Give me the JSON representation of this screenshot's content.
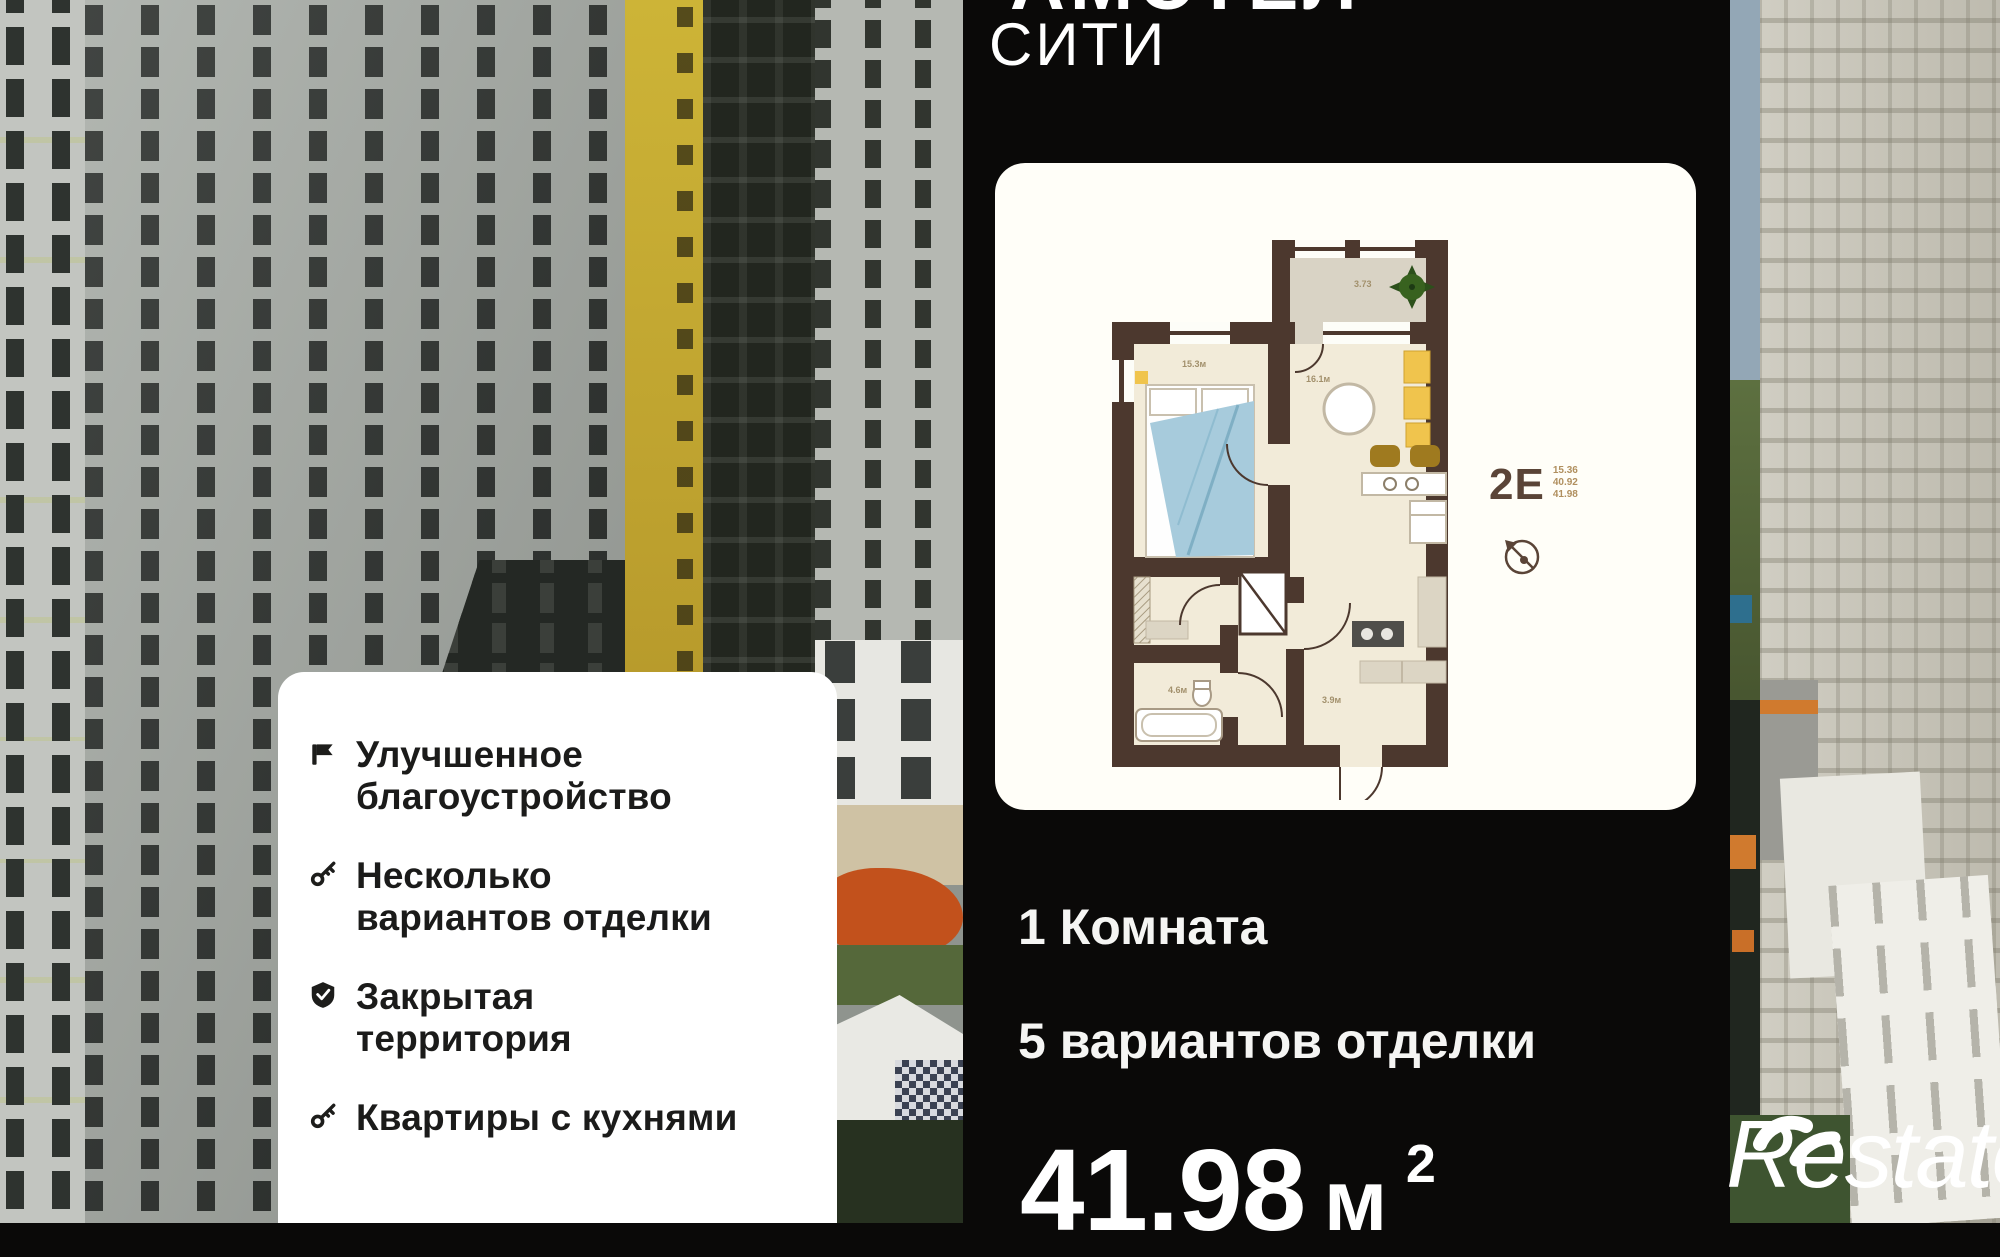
{
  "header": {
    "line1": "АМСТЕЛ",
    "line2": "СИТИ"
  },
  "features": {
    "items": [
      {
        "icon": "flag-icon",
        "lines": [
          "Улучшенное",
          "благоустройство"
        ]
      },
      {
        "icon": "key-icon",
        "lines": [
          "Несколько",
          "вариантов отделки"
        ]
      },
      {
        "icon": "shield-check-icon",
        "lines": [
          "Закрытая",
          "территория"
        ]
      },
      {
        "icon": "key-icon",
        "lines": [
          "Квартиры с кухнями"
        ]
      }
    ]
  },
  "plan": {
    "type_label": "2Е",
    "areas": [
      "15.36",
      "40.92",
      "41.98"
    ],
    "labels": {
      "balcony": "3.73",
      "bedroom": "15.3м",
      "living": "16.1м",
      "bath": "4.6м",
      "hall": "3.9м"
    }
  },
  "details": {
    "rooms": "1 Комната",
    "finishes": "5 вариантов отделки",
    "area_value": "41.98",
    "area_unit": "м",
    "area_sup": "2"
  },
  "watermark": {
    "brand": "Restate"
  },
  "colors": {
    "panel_black": "#0a0908",
    "plan_wall_brown": "#4c382e",
    "plan_floor_cream": "#f2ebd9",
    "blanket_blue": "#a7cbdc",
    "furniture_yellow": "#f0c44d",
    "playground_orange": "#c2511c",
    "facade_yellow": "#b89b2c"
  }
}
